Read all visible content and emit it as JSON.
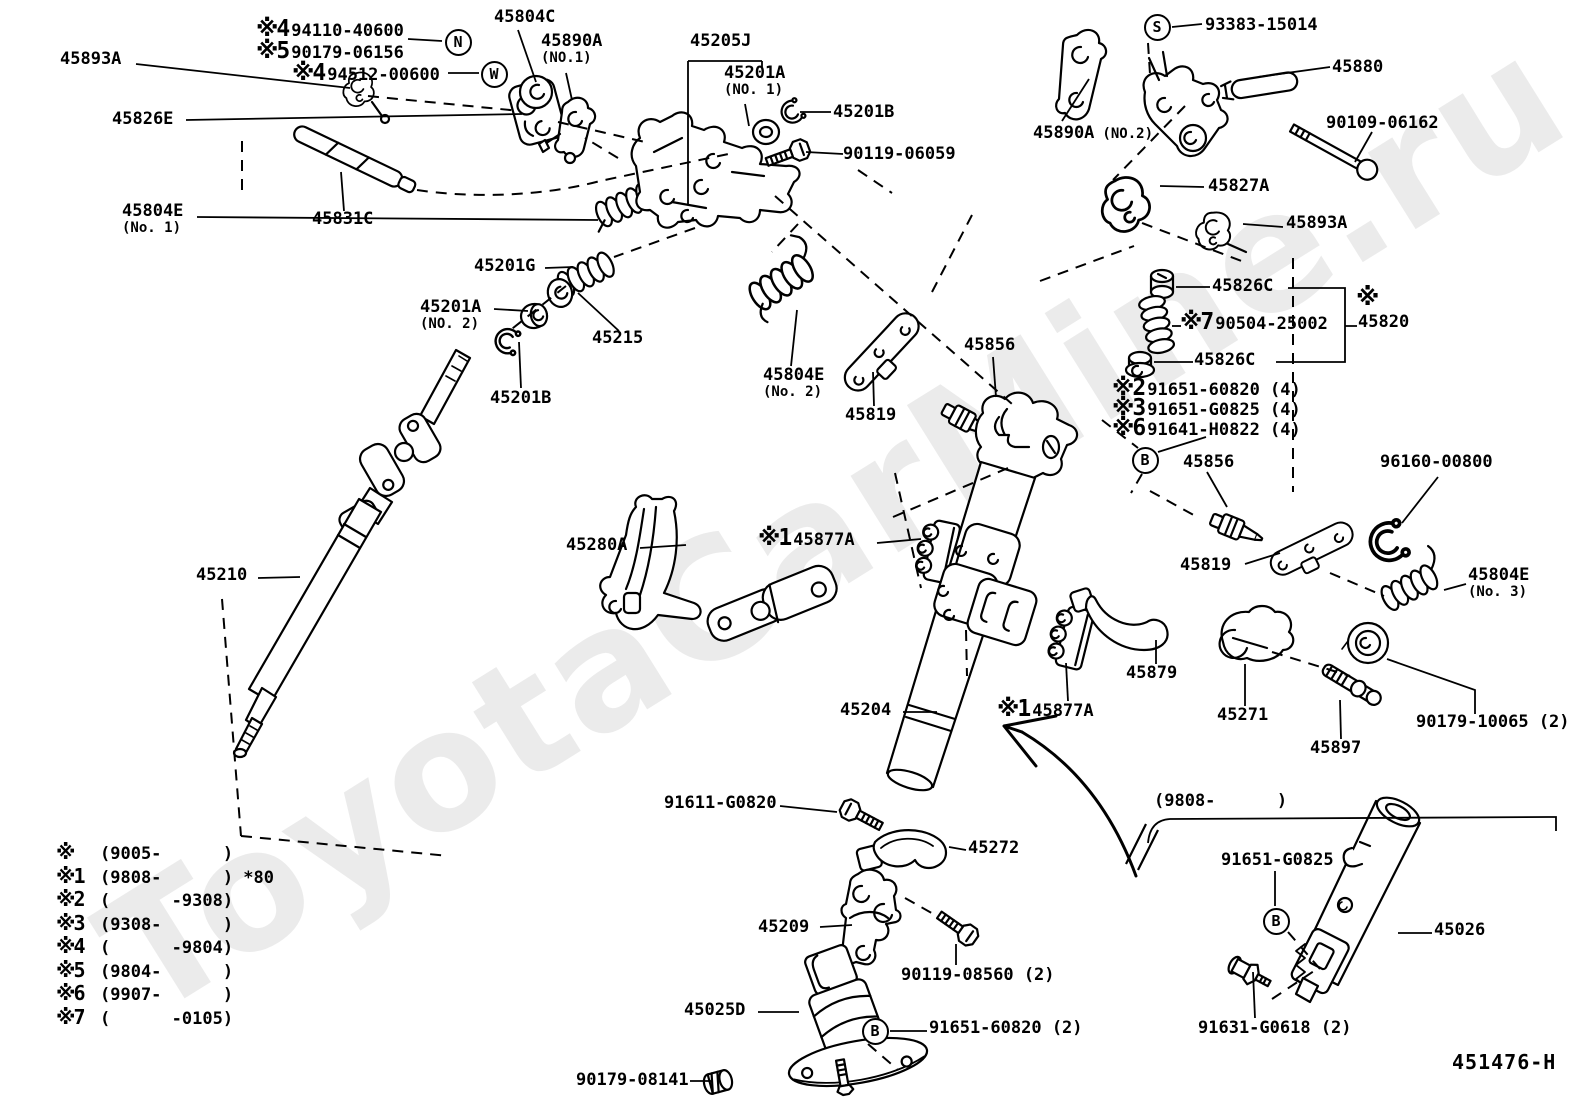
{
  "watermark": "ToyotaCarMine.ru",
  "labels": [
    {
      "name": "label-45893a-top-left",
      "text": "45893A",
      "x": 60,
      "y": 50
    },
    {
      "name": "label-94110-40600",
      "prefix": "※4",
      "text": "94110-40600",
      "x": 256,
      "y": 20
    },
    {
      "name": "label-90179-06156",
      "prefix": "※5",
      "text": "90179-06156",
      "x": 256,
      "y": 42
    },
    {
      "name": "label-94512-00600",
      "prefix": "※4",
      "text": "94512-00600",
      "x": 292,
      "y": 64
    },
    {
      "name": "label-45826e",
      "text": "45826E",
      "x": 112,
      "y": 110
    },
    {
      "name": "label-45804e-no1",
      "text": "45804E",
      "x": 122,
      "y": 202,
      "sub": "(No. 1)"
    },
    {
      "name": "label-45831c",
      "text": "45831C",
      "x": 312,
      "y": 210
    },
    {
      "name": "label-45804c",
      "text": "45804C",
      "x": 494,
      "y": 8
    },
    {
      "name": "label-45890a-no1",
      "text": "45890A",
      "x": 541,
      "y": 32,
      "sub": "(NO.1)"
    },
    {
      "name": "label-45205j",
      "text": "45205J",
      "x": 690,
      "y": 32
    },
    {
      "name": "label-45201a-no1",
      "text": "45201A",
      "x": 724,
      "y": 64,
      "sub": "(NO. 1)"
    },
    {
      "name": "label-45201b-no1",
      "text": "45201B",
      "x": 833,
      "y": 103
    },
    {
      "name": "label-90119-06059",
      "text": "90119-06059",
      "x": 843,
      "y": 145
    },
    {
      "name": "label-93383-15014",
      "text": "93383-15014",
      "x": 1205,
      "y": 16
    },
    {
      "name": "label-45880",
      "text": "45880",
      "x": 1332,
      "y": 58
    },
    {
      "name": "label-45890a-no2",
      "text": "45890A",
      "x": 1033,
      "y": 124,
      "inline": "(NO.2)"
    },
    {
      "name": "label-90109-06162",
      "text": "90109-06162",
      "x": 1326,
      "y": 114
    },
    {
      "name": "label-45827a",
      "text": "45827A",
      "x": 1208,
      "y": 177
    },
    {
      "name": "label-45893a-right",
      "text": "45893A",
      "x": 1286,
      "y": 214
    },
    {
      "name": "label-45826c-upper",
      "text": "45826C",
      "x": 1212,
      "y": 277
    },
    {
      "name": "label-90504-25002",
      "prefix": "※7",
      "text": "90504-25002",
      "x": 1180,
      "y": 313
    },
    {
      "name": "label-45820-mark",
      "text": "※",
      "x": 1356,
      "y": 288,
      "cls": "big"
    },
    {
      "name": "label-45820",
      "text": "45820",
      "x": 1358,
      "y": 313
    },
    {
      "name": "label-45826c-lower",
      "text": "45826C",
      "x": 1194,
      "y": 351
    },
    {
      "name": "label-91651-60820-4",
      "prefix": "※2",
      "text": "91651-60820 (4)",
      "x": 1112,
      "y": 379
    },
    {
      "name": "label-91651-g0825-4",
      "prefix": "※3",
      "text": "91651-G0825 (4)",
      "x": 1112,
      "y": 399
    },
    {
      "name": "label-91641-h0822-4",
      "prefix": "※6",
      "text": "91641-H0822 (4)",
      "x": 1112,
      "y": 419
    },
    {
      "name": "label-45856-right",
      "text": "45856",
      "x": 1183,
      "y": 453
    },
    {
      "name": "label-96160-00800",
      "text": "96160-00800",
      "x": 1380,
      "y": 453
    },
    {
      "name": "label-45819-right",
      "text": "45819",
      "x": 1180,
      "y": 556
    },
    {
      "name": "label-45804e-no3",
      "text": "45804E",
      "x": 1468,
      "y": 566,
      "sub": "(No. 3)"
    },
    {
      "name": "label-45280a",
      "text": "45280A",
      "x": 566,
      "y": 536
    },
    {
      "name": "label-45877a-1",
      "prefix": "※1",
      "text": "45877A",
      "x": 758,
      "y": 529
    },
    {
      "name": "label-45210",
      "text": "45210",
      "x": 196,
      "y": 566
    },
    {
      "name": "label-45804e-no2",
      "text": "45804E",
      "x": 763,
      "y": 366,
      "sub": "(No. 2)"
    },
    {
      "name": "label-45819-center",
      "text": "45819",
      "x": 845,
      "y": 406
    },
    {
      "name": "label-45856-center",
      "text": "45856",
      "x": 964,
      "y": 336
    },
    {
      "name": "label-45201g",
      "text": "45201G",
      "x": 474,
      "y": 257
    },
    {
      "name": "label-45201a-no2",
      "text": "45201A",
      "x": 420,
      "y": 298,
      "sub": "(NO. 2)"
    },
    {
      "name": "label-45215",
      "text": "45215",
      "x": 592,
      "y": 329
    },
    {
      "name": "label-45201b-no2",
      "text": "45201B",
      "x": 490,
      "y": 389
    },
    {
      "name": "label-45879",
      "text": "45879",
      "x": 1126,
      "y": 664
    },
    {
      "name": "label-45271",
      "text": "45271",
      "x": 1217,
      "y": 706
    },
    {
      "name": "label-90179-10065",
      "text": "90179-10065 (2)",
      "x": 1416,
      "y": 713
    },
    {
      "name": "label-45897",
      "text": "45897",
      "x": 1310,
      "y": 739
    },
    {
      "name": "label-45204",
      "text": "45204",
      "x": 840,
      "y": 701
    },
    {
      "name": "label-45877a-2",
      "prefix": "※1",
      "text": "45877A",
      "x": 997,
      "y": 700
    },
    {
      "name": "label-91611-g0820",
      "text": "91611-G0820",
      "x": 664,
      "y": 794
    },
    {
      "name": "label-9808-bracket",
      "text": "(9808-      )",
      "x": 1154,
      "y": 792
    },
    {
      "name": "label-45272",
      "text": "45272",
      "x": 968,
      "y": 839
    },
    {
      "name": "label-91651-g0825-b",
      "text": "91651-G0825",
      "x": 1221,
      "y": 851
    },
    {
      "name": "label-45026",
      "text": "45026",
      "x": 1434,
      "y": 921
    },
    {
      "name": "label-45209",
      "text": "45209",
      "x": 758,
      "y": 918
    },
    {
      "name": "label-90119-08560",
      "text": "90119-08560 (2)",
      "x": 901,
      "y": 966
    },
    {
      "name": "label-45025d",
      "text": "45025D",
      "x": 684,
      "y": 1001
    },
    {
      "name": "label-91651-60820-2",
      "text": "91651-60820 (2)",
      "x": 929,
      "y": 1019
    },
    {
      "name": "label-90179-08141",
      "text": "90179-08141",
      "x": 576,
      "y": 1071
    },
    {
      "name": "label-91631-g0618",
      "text": "91631-G0618 (2)",
      "x": 1198,
      "y": 1019
    },
    {
      "name": "label-451476-h",
      "text": "451476-H",
      "x": 1452,
      "y": 1053,
      "cls": "code"
    }
  ],
  "circled_letters": [
    {
      "letter": "N",
      "x": 458,
      "y": 42
    },
    {
      "letter": "W",
      "x": 494,
      "y": 74
    },
    {
      "letter": "S",
      "x": 1157,
      "y": 27
    },
    {
      "letter": "B",
      "x": 1145,
      "y": 460
    },
    {
      "letter": "B",
      "x": 1276,
      "y": 921
    },
    {
      "letter": "B",
      "x": 875,
      "y": 1031
    }
  ],
  "legend": {
    "rows": [
      {
        "k": "※",
        "v": "(9005-      )"
      },
      {
        "k": "※1",
        "v": "(9808-      ) *80"
      },
      {
        "k": "※2",
        "v": "(      -9308)"
      },
      {
        "k": "※3",
        "v": "(9308-      )"
      },
      {
        "k": "※4",
        "v": "(      -9804)"
      },
      {
        "k": "※5",
        "v": "(9804-      )"
      },
      {
        "k": "※6",
        "v": "(9907-      )"
      },
      {
        "k": "※7",
        "v": "(      -0105)"
      }
    ]
  }
}
